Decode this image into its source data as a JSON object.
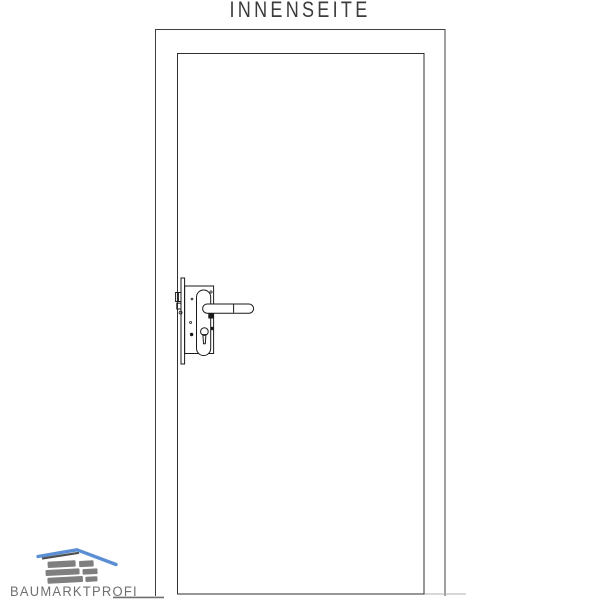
{
  "title": "INNENSEITE",
  "logo": {
    "text": "BAUMARKTPROFI",
    "icon": "house-roof-and-bricks-icon"
  },
  "drawing": {
    "parts": {
      "frame": "door-frame",
      "leaf": "door-leaf",
      "faceplate": "lock-faceplate",
      "case": "lock-case",
      "latch": "latch-bolt",
      "deadbolt": "dead-bolt",
      "escutcheon": "escutcheon-plate",
      "handle": "lever-handle",
      "keyhole": "profile-cylinder-keyhole"
    }
  },
  "colors": {
    "background": "#ffffff",
    "frame_line": "#3f3f3f",
    "door_line": "#2f2f2f",
    "hardware_line": "#1a1a1a",
    "floor_line_light": "#b0b0b0",
    "title_text": "#3c3c3c",
    "logo_text": "#6f6f6f",
    "logo_roof_blue": "#5b8fd4",
    "logo_roof_shadow": "#4f4f4f",
    "logo_brick": "#7f7f7f"
  }
}
